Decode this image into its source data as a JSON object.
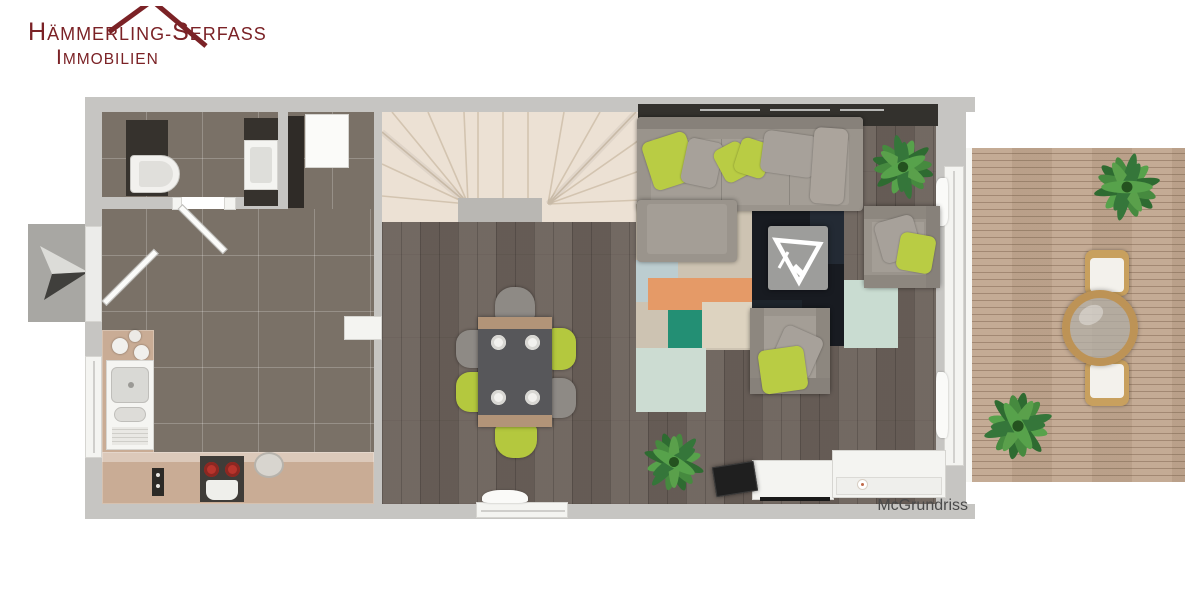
{
  "logo": {
    "l1_lead1": "H",
    "l1_rest1": "ÄMMERLING-",
    "l1_lead2": "S",
    "l1_rest2": "ERFASS",
    "l2_lead": "I",
    "l2_rest": "MMOBILIEN",
    "color": "#7b2226"
  },
  "watermark": {
    "text": "McGrundriss",
    "color": "#4a4a4a"
  },
  "icons": {
    "entrance_arrow": "direction-arrow-icon",
    "plants": "potted-plant-icon",
    "tv_triangle": "decor-triangle-icon"
  },
  "palette": {
    "wall": "#c6c5c2",
    "tile_floor": "#7a7167",
    "wood_floor": "#6b615a",
    "stairs": "#ece1d4",
    "terrace_deck": "#c1a78f",
    "sofa_gray": "#9a948c",
    "accent_green": "#b9cc44",
    "rug_navy": "#181b21",
    "rug_orange": "#e59a67",
    "rug_teal": "#238f74",
    "wicker": "#bd9356"
  }
}
